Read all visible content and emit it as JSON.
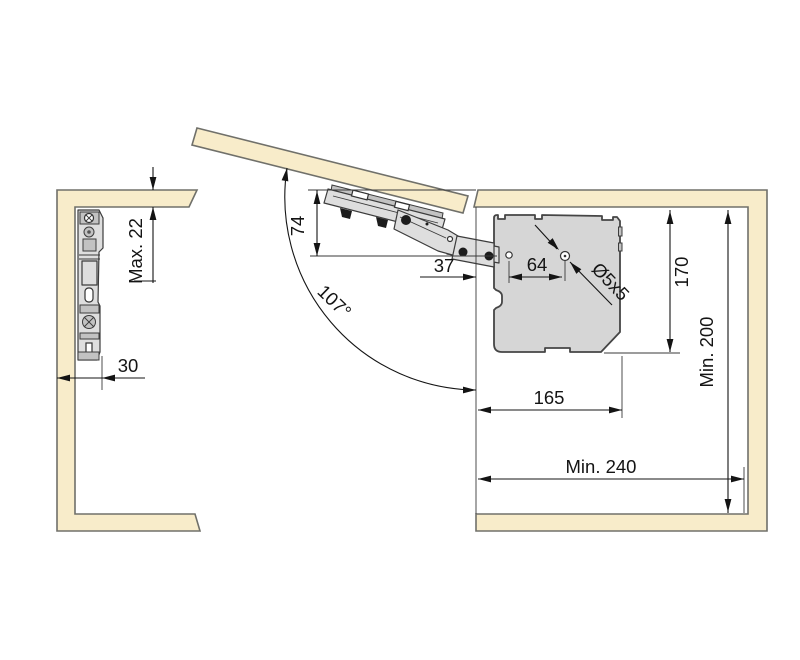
{
  "diagram": {
    "colors": {
      "background": "#ffffff",
      "panel_fill": "#f8ecca",
      "panel_stroke": "#70706a",
      "body_fill": "#d6d6d6",
      "body_stroke": "#454545",
      "mech_fill": "#dedede",
      "mech_dark": "#c2c2c2",
      "dim_color": "#141414"
    },
    "dimensions": {
      "max_panel_thickness": {
        "label": "Max. 22"
      },
      "side_clearance": {
        "label": "30"
      },
      "arm_drop": {
        "label": "74"
      },
      "opening_angle": {
        "label": "107°"
      },
      "front_hole_offset": {
        "label": "37"
      },
      "hole_spacing": {
        "label": "64"
      },
      "screw_size": {
        "label": "Ø5x5"
      },
      "body_height": {
        "label": "170"
      },
      "body_depth": {
        "label": "165"
      },
      "min_interior_height": {
        "label": "Min. 200"
      },
      "min_interior_depth": {
        "label": "Min. 240"
      }
    }
  }
}
